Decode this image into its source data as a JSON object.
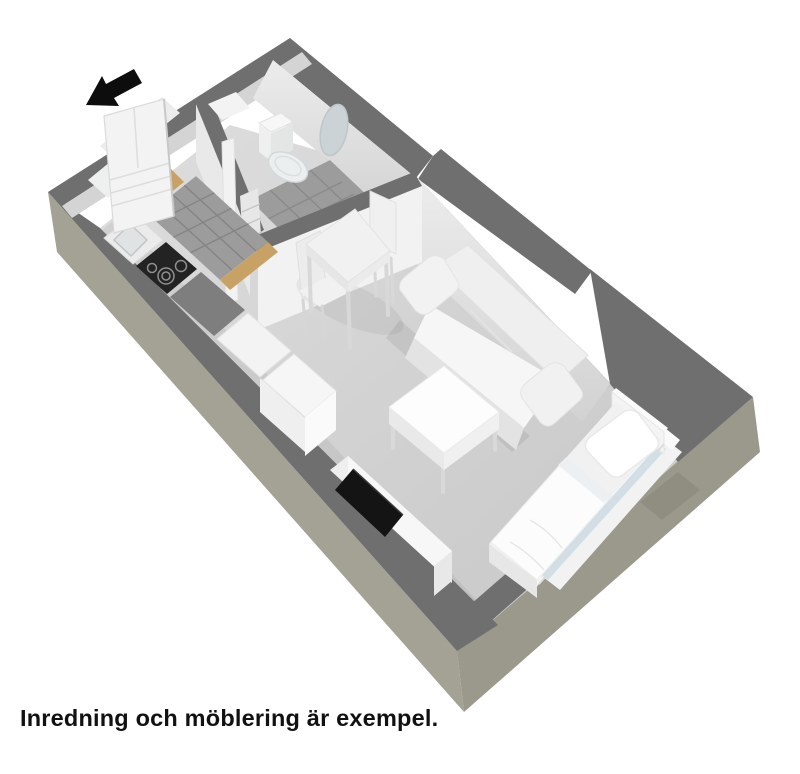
{
  "caption": {
    "text": "Inredning och möblering är exempel."
  },
  "scene": {
    "type": "isometric-3d-floorplan",
    "rooms": [
      "hall",
      "badrum",
      "kök",
      "vardagsrum"
    ],
    "objects": [
      "entrance-arrow",
      "entrance-door",
      "toilet",
      "round-mirror",
      "kitchen-sink",
      "cooktop",
      "kitchen-counters",
      "dining-table",
      "dining-chairs",
      "sofa",
      "coffee-table",
      "tv-bench",
      "tv-screen",
      "bed",
      "pillow",
      "duvet",
      "window"
    ]
  },
  "palette": {
    "bg": "#ffffff",
    "wall_top": "#6f6f6f",
    "wall_ext": "#a3a294",
    "wall_ext_side": "#9a998b",
    "wall_inner": "#e9e9e9",
    "wall_inner_far": "#d4d4d4",
    "floor": "#d8d8d8",
    "floor_far": "#c9c9c9",
    "tile": "#9c9c9c",
    "grout": "#858585",
    "wood": "#c8a265",
    "furn_white": "#f4f4f4",
    "furn_shade": "#e3e3e3",
    "counter_gray": "#7e7e7e",
    "appliance_black": "#232323",
    "tv_black": "#141414",
    "glass": "#cfdfe9",
    "mirror": "#ccd3d7",
    "arrow": "#0d0d0d",
    "text": "#111111"
  }
}
